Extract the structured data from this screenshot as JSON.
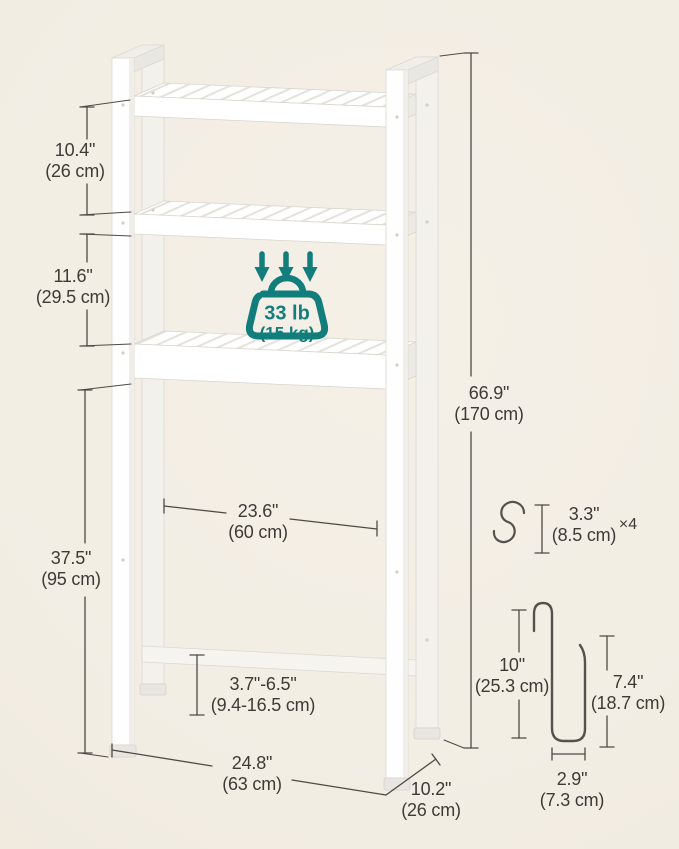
{
  "colors": {
    "background": "#f2ede3",
    "accent_teal": "#117e7c",
    "dimension_line": "#4d4a46",
    "label_text": "#3e3b37",
    "product_white": "#ffffff"
  },
  "icons": {
    "weight_capacity": "weight-load-icon",
    "load_arrows": "down-arrows-icon",
    "s_hook": "s-hook-icon",
    "door_hook": "over-door-hook-icon"
  },
  "weight_badge": {
    "value": "33 lb",
    "unit": "(15 kg)"
  },
  "labels": {
    "gap_top": {
      "inches": "10.4\"",
      "metric": "(26 cm)"
    },
    "gap_mid": {
      "inches": "11.6\"",
      "metric": "(29.5 cm)"
    },
    "clearance": {
      "inches": "37.5\"",
      "metric": "(95 cm)"
    },
    "height": {
      "inches": "66.9\"",
      "metric": "(170 cm)"
    },
    "inner_width": {
      "inches": "23.6\"",
      "metric": "(60 cm)"
    },
    "feet_range": {
      "inches": "3.7\"-6.5\"",
      "metric": "(9.4-16.5 cm)"
    },
    "width": {
      "inches": "24.8\"",
      "metric": "(63 cm)"
    },
    "depth": {
      "inches": "10.2\"",
      "metric": "(26 cm)"
    },
    "s_hook": {
      "inches": "3.3\"",
      "metric": "(8.5 cm)",
      "quantity": "×4"
    },
    "door_hook_height": {
      "inches": "10\"",
      "metric": "(25.3 cm)"
    },
    "door_hook_drop": {
      "inches": "7.4\"",
      "metric": "(18.7 cm)"
    },
    "door_hook_width": {
      "inches": "2.9\"",
      "metric": "(7.3 cm)"
    }
  }
}
